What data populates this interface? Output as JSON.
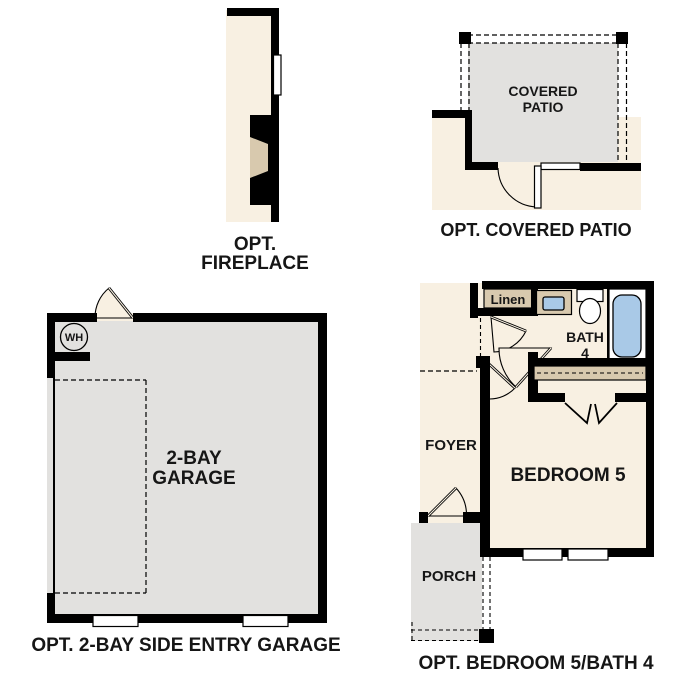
{
  "fireplace": {
    "caption1": "OPT.",
    "caption2": "FIREPLACE"
  },
  "patio": {
    "room1": "COVERED",
    "room2": "PATIO",
    "caption": "OPT. COVERED PATIO"
  },
  "garage": {
    "room1": "2-BAY",
    "room2": "GARAGE",
    "wh": "WH",
    "caption": "OPT. 2-BAY SIDE ENTRY GARAGE"
  },
  "bedroom": {
    "linen": "Linen",
    "bath1": "BATH",
    "bath2": "4",
    "bedroom": "BEDROOM 5",
    "foyer": "FOYER",
    "porch": "PORCH",
    "caption": "OPT. BEDROOM 5/BATH 4"
  },
  "colors": {
    "cream": "#f8f0e2",
    "gray": "#e2e1df",
    "tan": "#d8c9ae",
    "blue": "#a9c9e7",
    "wall": "#000000",
    "text": "#161616"
  }
}
